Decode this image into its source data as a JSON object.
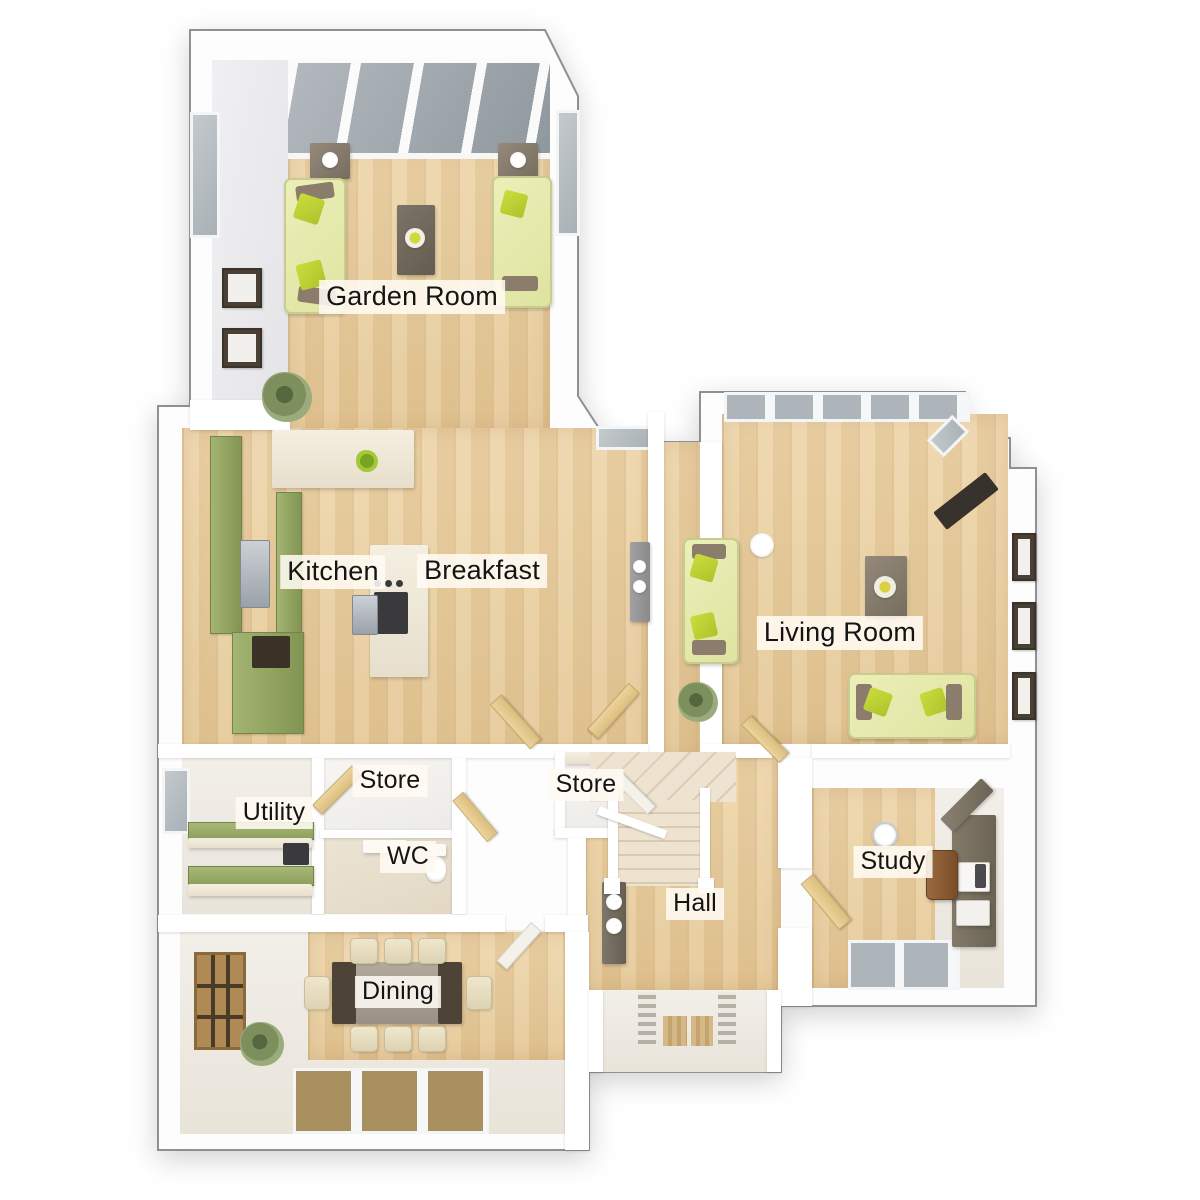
{
  "plan": {
    "rooms": [
      {
        "id": "garden-room",
        "label": "Garden Room"
      },
      {
        "id": "kitchen",
        "label": "Kitchen"
      },
      {
        "id": "breakfast",
        "label": "Breakfast"
      },
      {
        "id": "living-room",
        "label": "Living Room"
      },
      {
        "id": "utility",
        "label": "Utility"
      },
      {
        "id": "store-1",
        "label": "Store"
      },
      {
        "id": "store-2",
        "label": "Store"
      },
      {
        "id": "wc",
        "label": "WC"
      },
      {
        "id": "hall",
        "label": "Hall"
      },
      {
        "id": "study",
        "label": "Study"
      },
      {
        "id": "dining",
        "label": "Dining"
      }
    ],
    "colors": {
      "background": "#ffffff",
      "wall": "#ffffff",
      "outline": "#8f8f94",
      "floor_wood": "#ebd1a5",
      "kitchen_cabinet_green": "#94a55e",
      "sofa_green": "#e9ecb2",
      "pillow_lime": "#bfd337",
      "counter_cream": "#f0ead9",
      "table_taupe": "#8d8579",
      "table_dark_wood": "#4e4337",
      "chair_cream": "#e8dfc6",
      "glass_gray": "#aeb5ba",
      "plant_green": "#7c8f5c"
    }
  }
}
